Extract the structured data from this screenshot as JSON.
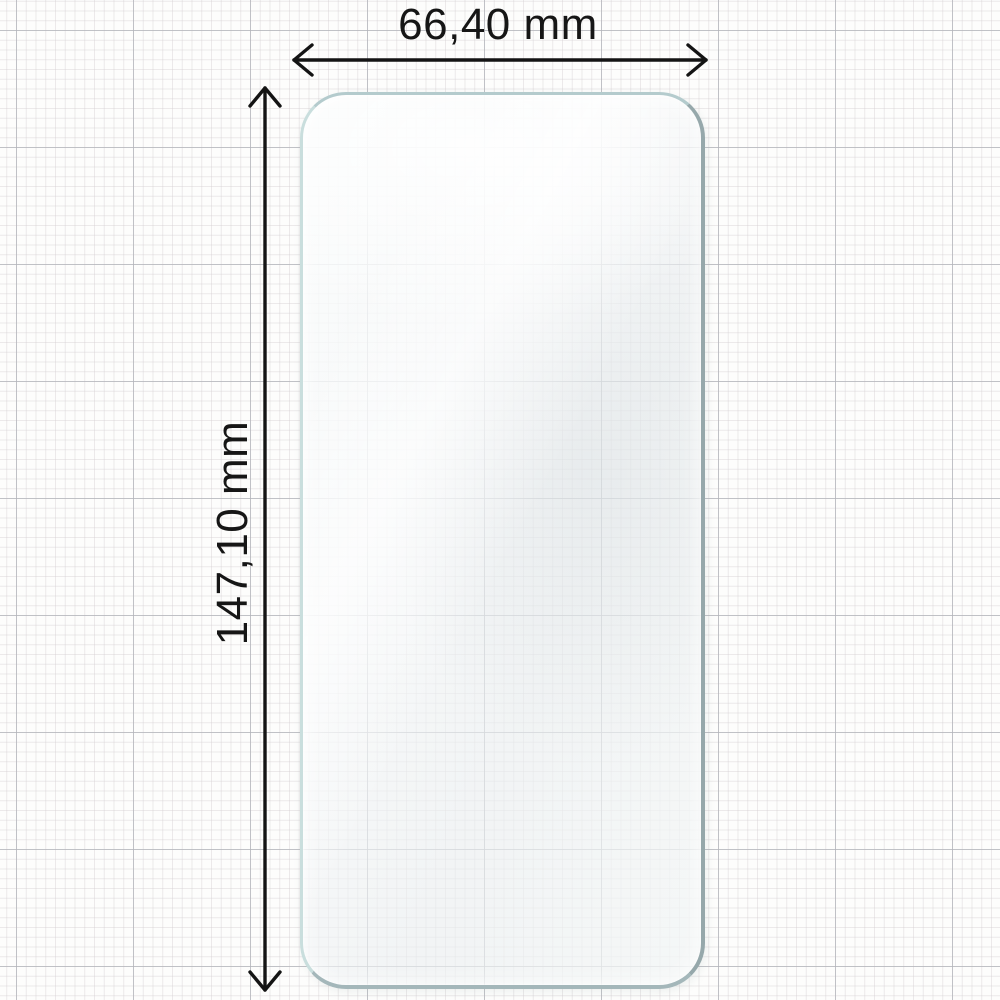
{
  "diagram": {
    "subject": "screen-protector-film",
    "width_dimension": {
      "label": "66,40 mm"
    },
    "height_dimension": {
      "label": "147,10 mm"
    },
    "colors": {
      "arrow": "#141414",
      "label_text": "#161616",
      "film_edge_light": "#c9dedd",
      "film_edge_dark": "#96a8ab",
      "film_surface": "#f2f5f6",
      "paper": "#fdfdfc",
      "grid_minor": "#d5d0d3",
      "grid_major": "#b2b4ba"
    }
  }
}
